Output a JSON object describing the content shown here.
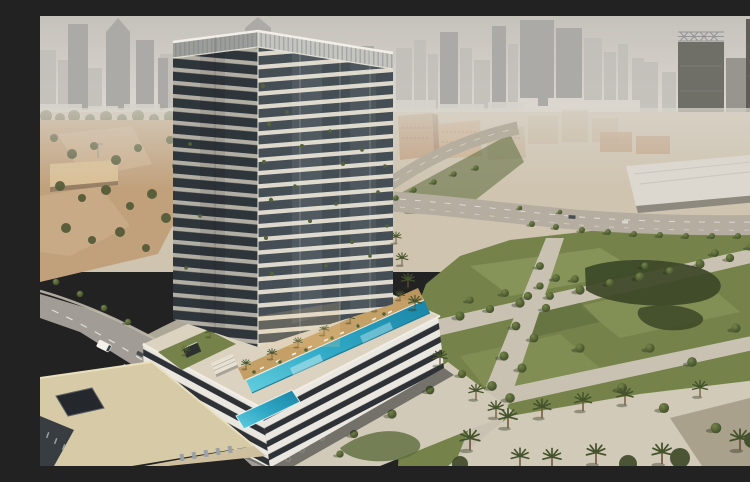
{
  "scene": {
    "type": "architectural-aerial-render",
    "alt": "Aerial rendering of a high-rise residential tower with a striped podium and rooftop infinity pool deck lined with palm trees, beside a large green park with paths and palms, a road with a white van, low beige buildings, a curved highway, a white warehouse, and a hazy city skyline of skyscrapers in the background"
  },
  "palette": {
    "sky_top": "#c5c1bb",
    "sky_bottom": "#ded9d1",
    "haze": "#d9d5cc",
    "skyline_back": "#c1beb9",
    "skyline_front": "#acaaa6",
    "skyline_dark": "#97958e",
    "rtower_a": "#6f6e67",
    "rtower_b": "#5e5d57",
    "horizon_white": "#d7d4cd",
    "ground": "#cfc4b0",
    "sand": "#c1a17c",
    "sand_light": "#cfb491",
    "wall_beige": "#d9bf94",
    "olive": "#5a5e3b",
    "tree_dark": "#3c4827",
    "tree_mid": "#556338",
    "tree_light": "#74854a",
    "tree_shadow": "#27301b",
    "trunk": "#6e5539",
    "frond": "#44532c",
    "grass": "#75834b",
    "grass_light": "#8b985c",
    "grass_dark": "#5d6c3d",
    "path": "#c9c2b2",
    "path_warm": "#d2cab8",
    "pave_shade": "#80775f",
    "road": "#a19d96",
    "road_mark": "#edebe4",
    "sidewalk": "#c0b9ac",
    "warehouse": "#dcd8d0",
    "warehouse_base": "#8e897f",
    "tan1": "#c09e7d",
    "tan2": "#cbad8c",
    "tan3": "#c5b49a",
    "slab_sun": "#ded9cc",
    "glass_sun": "#454e55",
    "slab_shade": "#b2aea4",
    "glass_shade": "#2f363b",
    "crown_sun": "#c4c5bf",
    "crown_shade": "#9b9e99",
    "fin": "#7e8184",
    "pod_white": "#eae7e0",
    "pod_dark": "#2e3236",
    "deck": "#dbd2c0",
    "wood": "#c39d62",
    "pool_light": "#63cedd",
    "pool_mid": "#2fa9c6",
    "pool_deep": "#1a84a6",
    "lounger": "#f4efe2",
    "umbrella": "#ece6d9",
    "umb_pole": "#8a7a62",
    "beige_roof": "#d7caa7",
    "beige_wall": "#cec09f",
    "dark_building": "#383d42",
    "window_lit": "#9aa0a4",
    "shadow": "#14181a",
    "van": "#f3f1ea"
  }
}
